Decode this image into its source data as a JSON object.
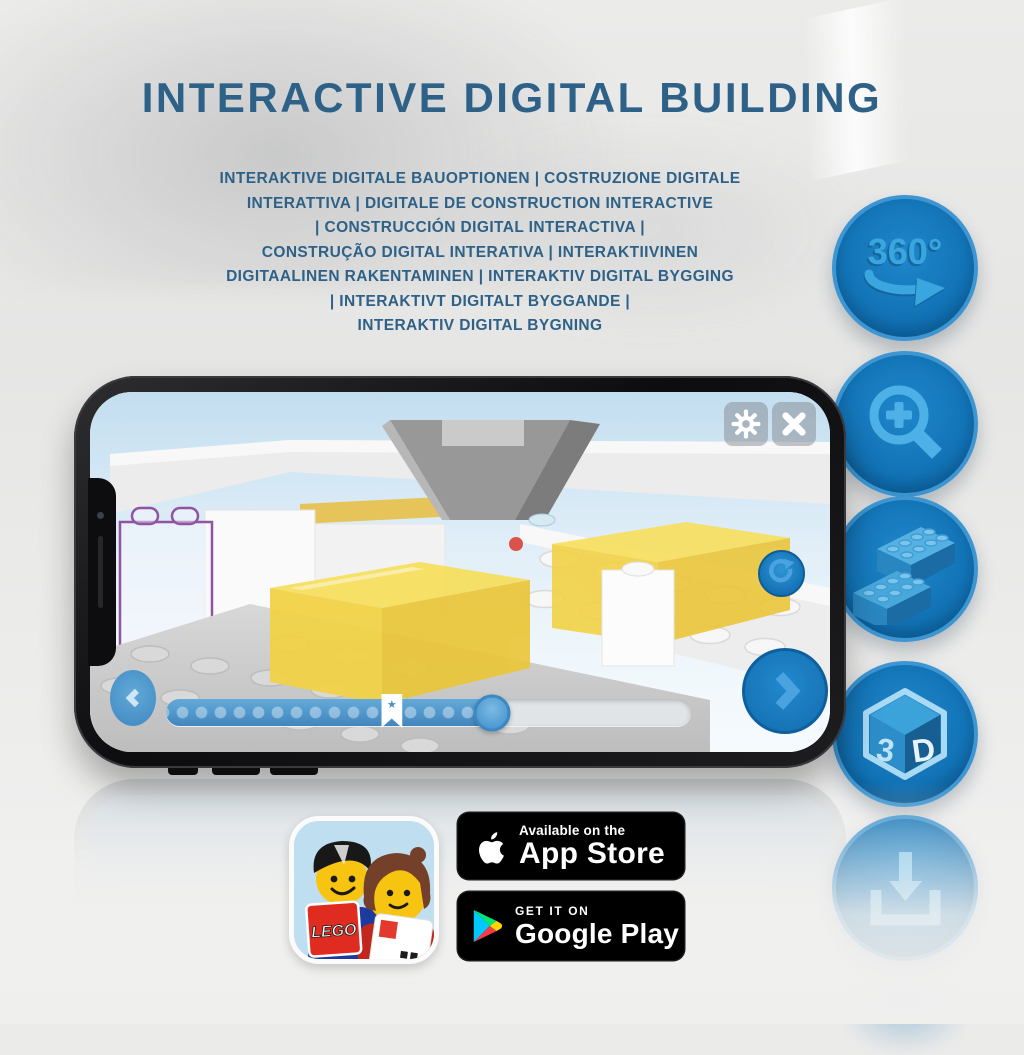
{
  "header": {
    "title": "INTERACTIVE DIGITAL BUILDING",
    "subtitle_lines": [
      "INTERAKTIVE DIGITALE BAUOPTIONEN | COSTRUZIONE DIGITALE",
      "INTERATTIVA | DIGITALE DE CONSTRUCTION INTERACTIVE",
      "| CONSTRUCCIÓN DIGITAL INTERACTIVA |",
      "CONSTRUÇÃO DIGITAL INTERATIVA | INTERAKTIIVINEN",
      "DIGITAALINEN RAKENTAMINEN | INTERAKTIV DIGITAL BYGGING",
      "| INTERAKTIVT DIGITALT BYGGANDE |",
      "INTERAKTIV DIGITAL BYGNING"
    ]
  },
  "feature_icons": {
    "items": [
      "360-rotation",
      "zoom-in",
      "brick-options",
      "3d-view",
      "download-instructions"
    ],
    "rotation_label": "360°",
    "cube_letter_1": "3",
    "cube_letter_2": "D"
  },
  "phone": {
    "slider": {
      "progress_percent": 62,
      "bookmark_percent": 43,
      "bookmark_star": "★"
    }
  },
  "footer": {
    "app_icon_logo_text": "LEGO",
    "app_store_badge": {
      "line1": "Available on the",
      "line2": "App Store"
    },
    "google_play_badge": {
      "line1": "GET IT ON",
      "line2": "Google Play"
    }
  },
  "colors": {
    "heading_blue": "#2e6187",
    "circle_blue": "#1278bd",
    "glyph_blue": "#3aa6e0",
    "slider_blue": "#4a90c4",
    "phone_screen_sky": "#cfe4f2"
  }
}
